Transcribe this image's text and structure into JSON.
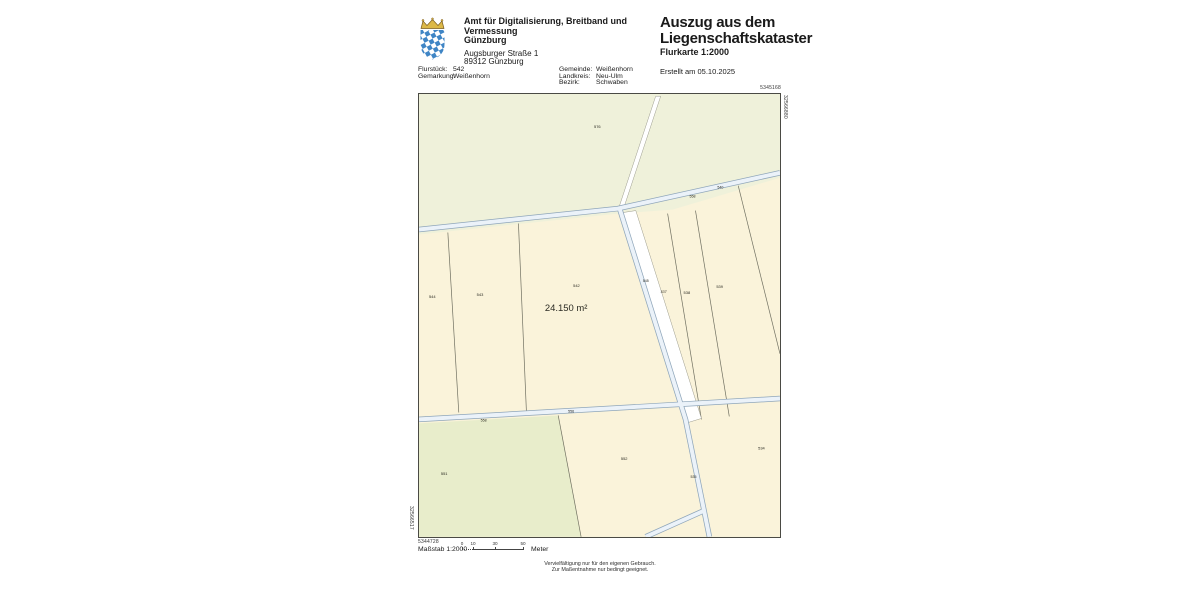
{
  "header": {
    "agency_line1": "Amt für Digitalisierung, Breitband und Vermessung",
    "agency_line2": "Günzburg",
    "address_line1": "Augsburger Straße 1",
    "address_line2": "89312 Günzburg",
    "title_line1": "Auszug aus dem",
    "title_line2": "Liegenschaftskataster",
    "subtitle": "Flurkarte 1:2000",
    "created": "Erstellt am 05.10.2025"
  },
  "info": {
    "left": [
      {
        "label": "Flurstück:",
        "value": "542"
      },
      {
        "label": "Gemarkung:",
        "value": "Weißenhorn"
      }
    ],
    "right": [
      {
        "label": "Gemeinde:",
        "value": "Weißenhorn"
      },
      {
        "label": "Landkreis:",
        "value": "Neu-Ulm"
      },
      {
        "label": "Bezirk:",
        "value": "Schwaben"
      }
    ]
  },
  "map": {
    "corner_coords": {
      "top_right_h": "5345168",
      "top_right_v": "32566880",
      "bottom_left_v": "32566517",
      "bottom_left_h": "5344728"
    },
    "colors": {
      "background": "#eff1da",
      "parcel_cream": "#faf3da",
      "parcel_green": "#e8edcb",
      "parcel_white": "#ffffff",
      "road_fill": "#ebf2f9",
      "road_casing": "#8fa6ba",
      "boundary": "#6f6f60"
    },
    "labels": [
      {
        "text": "576",
        "x": 176,
        "y": 34,
        "s": 4
      },
      {
        "text": "544",
        "x": 10,
        "y": 205,
        "s": 4
      },
      {
        "text": "543",
        "x": 58,
        "y": 203,
        "s": 4
      },
      {
        "text": "542",
        "x": 155,
        "y": 194,
        "s": 4
      },
      {
        "text": "24.150 m²",
        "x": 148,
        "y": 218,
        "s": 9.5,
        "anchor": "middle",
        "n": "area-label"
      },
      {
        "text": "540",
        "x": 300,
        "y": 95,
        "s": 3.6
      },
      {
        "text": "558",
        "x": 272,
        "y": 104,
        "s": 3.6
      },
      {
        "text": "545",
        "x": 225,
        "y": 189,
        "s": 3.6
      },
      {
        "text": "537",
        "x": 243,
        "y": 200,
        "s": 3.6,
        "i": 1
      },
      {
        "text": "538",
        "x": 266,
        "y": 201,
        "s": 4
      },
      {
        "text": "539",
        "x": 299,
        "y": 195,
        "s": 4
      },
      {
        "text": "556",
        "x": 150,
        "y": 320,
        "s": 3.6
      },
      {
        "text": "558",
        "x": 62,
        "y": 329,
        "s": 3.6
      },
      {
        "text": "551",
        "x": 22,
        "y": 383,
        "s": 4
      },
      {
        "text": "552",
        "x": 203,
        "y": 368,
        "s": 4
      },
      {
        "text": "534",
        "x": 341,
        "y": 357,
        "s": 4
      },
      {
        "text": "535",
        "x": 273,
        "y": 386,
        "s": 3.6
      }
    ]
  },
  "footer": {
    "scale_label": "Maßstab 1:2000",
    "scale_unit": "Meter",
    "scale_ticks": [
      {
        "value": "0",
        "px": 0
      },
      {
        "value": "10",
        "px": 11
      },
      {
        "value": "30",
        "px": 33
      },
      {
        "value": "50",
        "px": 61
      }
    ],
    "notice_line1": "Vervielfältigung nur für den eigenen Gebrauch.",
    "notice_line2": "Zur Maßentnahme nur bedingt geeignet."
  }
}
